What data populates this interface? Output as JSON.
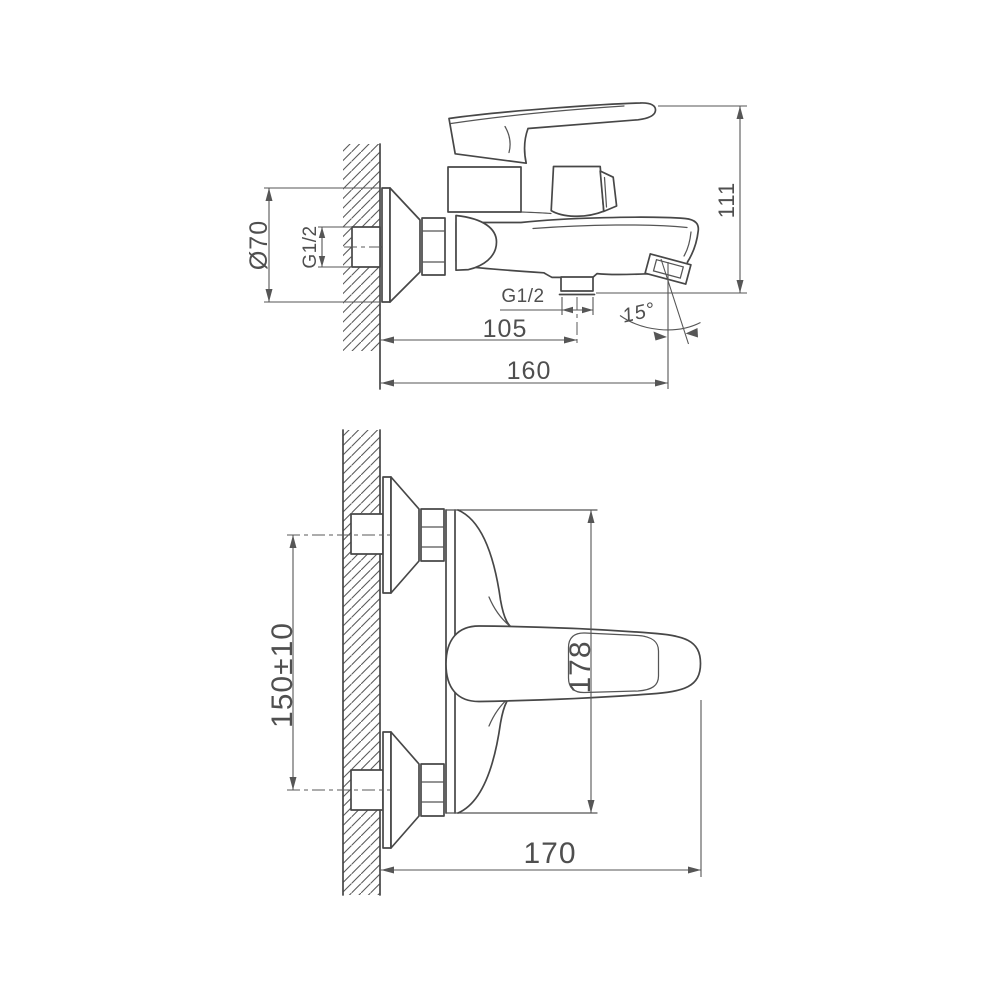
{
  "drawing": {
    "background": "#ffffff",
    "colors": {
      "line": "#474747",
      "dim_text": "#4f4f4f",
      "dim_line": "#565656"
    },
    "views": [
      {
        "name": "side-view",
        "dimensions": [
          {
            "id": "escutcheon-diameter",
            "label": "Ø70"
          },
          {
            "id": "wall-inlet-thread",
            "label": "G1/2"
          },
          {
            "id": "height",
            "label": "111"
          },
          {
            "id": "shower-outlet-thread",
            "label": "G1/2"
          },
          {
            "id": "outlet-offset",
            "label": "105"
          },
          {
            "id": "spout-angle",
            "label": "15°"
          },
          {
            "id": "overall-depth",
            "label": "160"
          }
        ]
      },
      {
        "name": "plan-view",
        "dimensions": [
          {
            "id": "inlet-spacing",
            "label": "150±10"
          },
          {
            "id": "body-width",
            "label": "178"
          },
          {
            "id": "overall-depth",
            "label": "170"
          }
        ]
      }
    ]
  }
}
